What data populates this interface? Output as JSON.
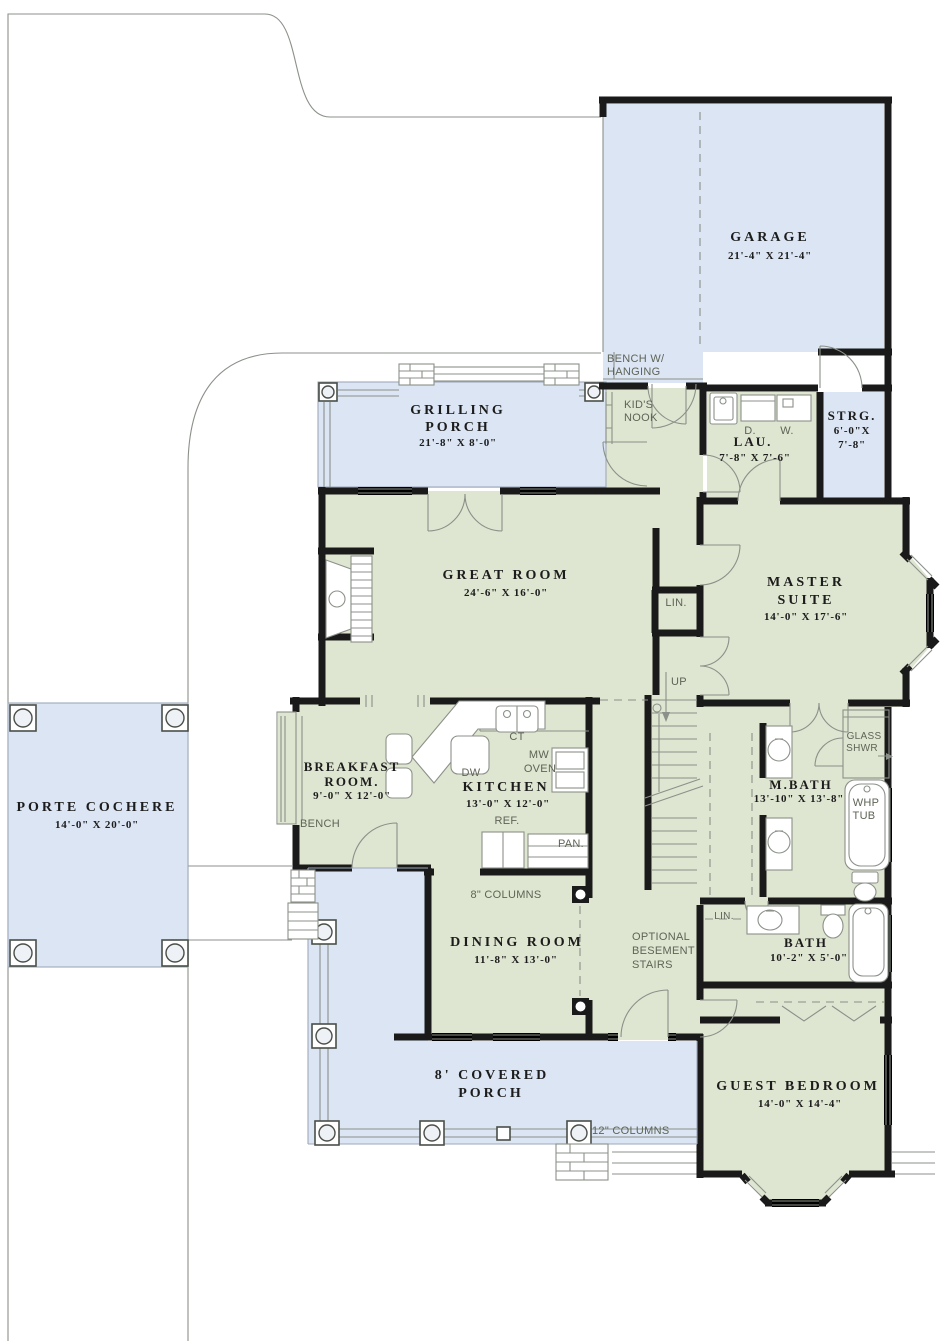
{
  "plan": {
    "colors": {
      "green": "#dee5d0",
      "blue": "#dbe5f4",
      "wall": "#1a1a1a",
      "line": "#8b9189",
      "label": "#5f6456",
      "text": "#1c1c1c"
    },
    "rooms": {
      "garage": {
        "name": "GARAGE",
        "dims": "21'-4\" X 21'-4\""
      },
      "grilling_porch": {
        "line1": "GRILLING",
        "line2": "PORCH",
        "dims": "21'-8\" X 8'-0\""
      },
      "laundry": {
        "name": "LAU.",
        "dims": "7'-8\" X 7'-6\""
      },
      "storage": {
        "name": "STRG.",
        "dims_line1": "6'-0\"X",
        "dims_line2": "7'-8\""
      },
      "great_room": {
        "name": "GREAT ROOM",
        "dims": "24'-6\" X 16'-0\""
      },
      "master_suite": {
        "line1": "MASTER",
        "line2": "SUITE",
        "dims": "14'-0\" X 17'-6\""
      },
      "breakfast": {
        "line1": "BREAKFAST",
        "line2": "ROOM.",
        "dims": "9'-0\" X 12'-0\""
      },
      "kitchen": {
        "name": "KITCHEN",
        "dims": "13'-0\" X 12'-0\""
      },
      "master_bath": {
        "name": "M.BATH",
        "dims": "13'-10\" X 13'-8\""
      },
      "porte_cochere": {
        "name": "PORTE COCHERE",
        "dims": "14'-0\" X 20'-0\""
      },
      "dining": {
        "name": "DINING ROOM",
        "dims": "11'-8\" X 13'-0\""
      },
      "bath": {
        "name": "BATH",
        "dims": "10'-2\" X 5'-0\""
      },
      "guest_bedroom": {
        "name": "GUEST BEDROOM",
        "dims": "14'-0\" X 14'-4\""
      },
      "covered_porch": {
        "line1": "8' COVERED",
        "line2": "PORCH"
      }
    },
    "annotations": {
      "bench_hanging_line1": "BENCH W/",
      "bench_hanging_line2": "HANGING",
      "kids_nook_line1": "KID'S",
      "kids_nook_line2": "NOOK",
      "dryer": "D.",
      "washer": "W.",
      "linen_upper": "LIN.",
      "linen_lower": "LIN.",
      "up": "UP",
      "cooktop": "CT",
      "microwave_line1": "MW",
      "microwave_line2": "OVEN",
      "dishwasher": "DW",
      "refrigerator": "REF.",
      "pantry": "PAN.",
      "bench": "BENCH",
      "glass_shower_line1": "GLASS",
      "glass_shower_line2": "SHWR",
      "whirlpool_line1": "WHP",
      "whirlpool_line2": "TUB",
      "columns_8": "8\" COLUMNS",
      "columns_12": "12\" COLUMNS",
      "basement_line1": "OPTIONAL",
      "basement_line2": "BESEMENT",
      "basement_line3": "STAIRS"
    }
  }
}
